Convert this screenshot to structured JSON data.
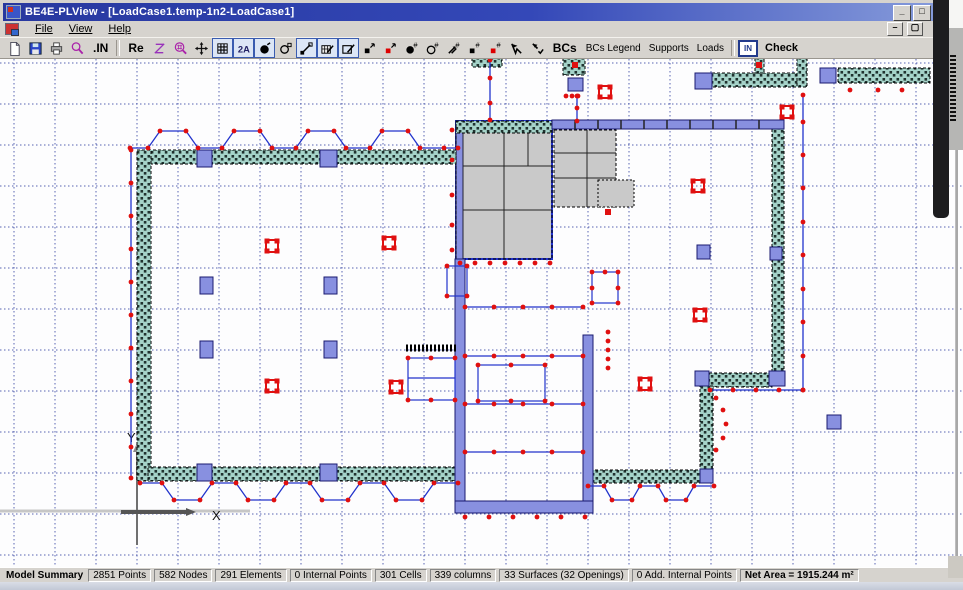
{
  "window": {
    "title": "BE4E-PLView - [LoadCase1.temp-1n2-LoadCase1]"
  },
  "menu": {
    "items": [
      "File",
      "View",
      "Help"
    ]
  },
  "toolbar": {
    "in_units_label": ".IN",
    "re_label": "Re",
    "bcs_label": "BCs",
    "bcs_legend_label": "BCs Legend",
    "supports_label": "Supports",
    "loads_label": "Loads",
    "annotate_label": "2A",
    "in_box_label": "IN",
    "check_label": "Check"
  },
  "axes": {
    "x_label": "X",
    "y_label": "Y"
  },
  "status": {
    "summary_label": "Model Summary",
    "segments": [
      "2851 Points",
      "582 Nodes",
      "291 Elements",
      "0 Internal Points",
      "301 Cells",
      "339 columns",
      "33 Surfaces (32 Openings)",
      "0 Add. Internal Points"
    ],
    "net_area": "Net Area = 1915.244 m²"
  },
  "colors": {
    "titlebar": "#27389f",
    "wall_teal": "#a5d3c9",
    "column_purple": "#8890e0",
    "outline_blue": "#2233cc",
    "marker_red": "#e01010",
    "grid_navy": "#2f3f9e",
    "slab_gray": "#c9c9c9"
  }
}
